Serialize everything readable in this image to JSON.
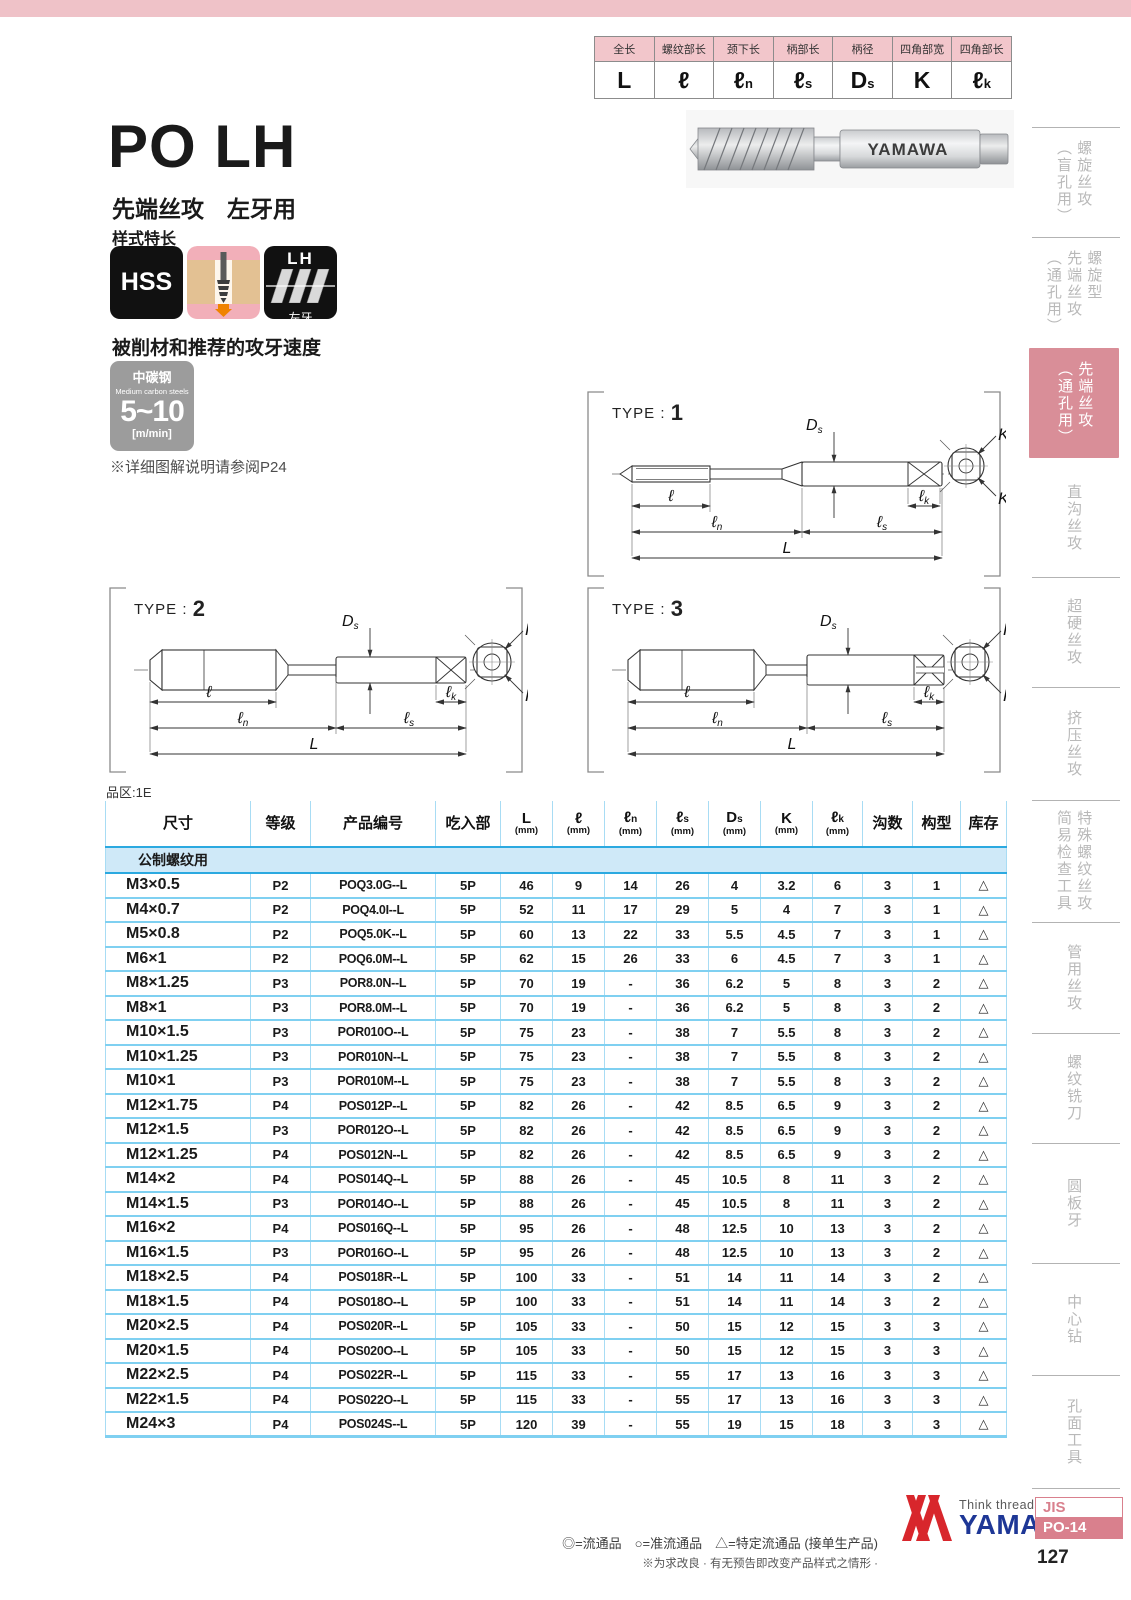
{
  "symbol_table": {
    "headers": [
      "全长",
      "螺纹部长",
      "颈下长",
      "柄部长",
      "柄径",
      "四角部宽",
      "四角部长"
    ],
    "symbols": [
      "L",
      "ℓ",
      "ℓn",
      "ℓs",
      "Ds",
      "K",
      "ℓk"
    ]
  },
  "header": {
    "title": "PO LH",
    "subtitle": "先端丝攻　左牙用",
    "features_label": "样式特长",
    "badge_hss": "HSS",
    "badge_lh_top": "LH",
    "badge_lh_bottom": "左牙",
    "photo_brand": "YAMAWA"
  },
  "speed": {
    "heading": "被削材和推荐的攻牙速度",
    "material_cn": "中碳钢",
    "material_en": "Medium carbon steels",
    "range": "5~10",
    "unit": "[m/min]",
    "note": "※详细图解说明请参阅P24"
  },
  "diagrams": {
    "label_prefix": "TYPE : ",
    "types": [
      "1",
      "2",
      "3"
    ],
    "dims": {
      "l": "ℓ",
      "ln": "ℓn",
      "ls": "ℓs",
      "L": "L",
      "Ds": "Ds",
      "lk": "ℓk",
      "K": "K"
    }
  },
  "table": {
    "zone_label": "品区:1E",
    "headers": [
      {
        "t": "尺寸"
      },
      {
        "t": "等级"
      },
      {
        "t": "产品编号"
      },
      {
        "t": "吃入部"
      },
      {
        "t": "L",
        "u": "(mm)"
      },
      {
        "t": "ℓ",
        "u": "(mm)"
      },
      {
        "t": "ℓn",
        "u": "(mm)"
      },
      {
        "t": "ℓs",
        "u": "(mm)"
      },
      {
        "t": "Ds",
        "u": "(mm)"
      },
      {
        "t": "K",
        "u": "(mm)"
      },
      {
        "t": "ℓk",
        "u": "(mm)"
      },
      {
        "t": "沟数"
      },
      {
        "t": "构型"
      },
      {
        "t": "库存"
      }
    ],
    "section_label": "公制螺纹用",
    "rows": [
      [
        "M3×0.5",
        "P2",
        "POQ3.0G--L",
        "5P",
        "46",
        "9",
        "14",
        "26",
        "4",
        "3.2",
        "6",
        "3",
        "1",
        "△"
      ],
      [
        "M4×0.7",
        "P2",
        "POQ4.0I--L",
        "5P",
        "52",
        "11",
        "17",
        "29",
        "5",
        "4",
        "7",
        "3",
        "1",
        "△"
      ],
      [
        "M5×0.8",
        "P2",
        "POQ5.0K--L",
        "5P",
        "60",
        "13",
        "22",
        "33",
        "5.5",
        "4.5",
        "7",
        "3",
        "1",
        "△"
      ],
      [
        "M6×1",
        "P2",
        "POQ6.0M--L",
        "5P",
        "62",
        "15",
        "26",
        "33",
        "6",
        "4.5",
        "7",
        "3",
        "1",
        "△"
      ],
      [
        "M8×1.25",
        "P3",
        "POR8.0N--L",
        "5P",
        "70",
        "19",
        "-",
        "36",
        "6.2",
        "5",
        "8",
        "3",
        "2",
        "△"
      ],
      [
        "M8×1",
        "P3",
        "POR8.0M--L",
        "5P",
        "70",
        "19",
        "-",
        "36",
        "6.2",
        "5",
        "8",
        "3",
        "2",
        "△"
      ],
      [
        "M10×1.5",
        "P3",
        "POR010O--L",
        "5P",
        "75",
        "23",
        "-",
        "38",
        "7",
        "5.5",
        "8",
        "3",
        "2",
        "△"
      ],
      [
        "M10×1.25",
        "P3",
        "POR010N--L",
        "5P",
        "75",
        "23",
        "-",
        "38",
        "7",
        "5.5",
        "8",
        "3",
        "2",
        "△"
      ],
      [
        "M10×1",
        "P3",
        "POR010M--L",
        "5P",
        "75",
        "23",
        "-",
        "38",
        "7",
        "5.5",
        "8",
        "3",
        "2",
        "△"
      ],
      [
        "M12×1.75",
        "P4",
        "POS012P--L",
        "5P",
        "82",
        "26",
        "-",
        "42",
        "8.5",
        "6.5",
        "9",
        "3",
        "2",
        "△"
      ],
      [
        "M12×1.5",
        "P3",
        "POR012O--L",
        "5P",
        "82",
        "26",
        "-",
        "42",
        "8.5",
        "6.5",
        "9",
        "3",
        "2",
        "△"
      ],
      [
        "M12×1.25",
        "P4",
        "POS012N--L",
        "5P",
        "82",
        "26",
        "-",
        "42",
        "8.5",
        "6.5",
        "9",
        "3",
        "2",
        "△"
      ],
      [
        "M14×2",
        "P4",
        "POS014Q--L",
        "5P",
        "88",
        "26",
        "-",
        "45",
        "10.5",
        "8",
        "11",
        "3",
        "2",
        "△"
      ],
      [
        "M14×1.5",
        "P3",
        "POR014O--L",
        "5P",
        "88",
        "26",
        "-",
        "45",
        "10.5",
        "8",
        "11",
        "3",
        "2",
        "△"
      ],
      [
        "M16×2",
        "P4",
        "POS016Q--L",
        "5P",
        "95",
        "26",
        "-",
        "48",
        "12.5",
        "10",
        "13",
        "3",
        "2",
        "△"
      ],
      [
        "M16×1.5",
        "P3",
        "POR016O--L",
        "5P",
        "95",
        "26",
        "-",
        "48",
        "12.5",
        "10",
        "13",
        "3",
        "2",
        "△"
      ],
      [
        "M18×2.5",
        "P4",
        "POS018R--L",
        "5P",
        "100",
        "33",
        "-",
        "51",
        "14",
        "11",
        "14",
        "3",
        "2",
        "△"
      ],
      [
        "M18×1.5",
        "P4",
        "POS018O--L",
        "5P",
        "100",
        "33",
        "-",
        "51",
        "14",
        "11",
        "14",
        "3",
        "2",
        "△"
      ],
      [
        "M20×2.5",
        "P4",
        "POS020R--L",
        "5P",
        "105",
        "33",
        "-",
        "50",
        "15",
        "12",
        "15",
        "3",
        "3",
        "△"
      ],
      [
        "M20×1.5",
        "P4",
        "POS020O--L",
        "5P",
        "105",
        "33",
        "-",
        "50",
        "15",
        "12",
        "15",
        "3",
        "3",
        "△"
      ],
      [
        "M22×2.5",
        "P4",
        "POS022R--L",
        "5P",
        "115",
        "33",
        "-",
        "55",
        "17",
        "13",
        "16",
        "3",
        "3",
        "△"
      ],
      [
        "M22×1.5",
        "P4",
        "POS022O--L",
        "5P",
        "115",
        "33",
        "-",
        "55",
        "17",
        "13",
        "16",
        "3",
        "3",
        "△"
      ],
      [
        "M24×3",
        "P4",
        "POS024S--L",
        "5P",
        "120",
        "39",
        "-",
        "55",
        "19",
        "15",
        "18",
        "3",
        "3",
        "△"
      ]
    ]
  },
  "footer": {
    "legend": "◎=流通品　○=准流通品　△=特定流通品 (接单生产品)",
    "note": "※为求改良 · 有无预告即改变产品样式之情形 ·",
    "tagline": "Think threads with",
    "brand": "YAMAWA"
  },
  "sidebar": {
    "tabs": [
      {
        "lines": [
          "螺旋丝攻",
          "（盲孔用）"
        ],
        "active": false
      },
      {
        "lines": [
          "螺旋型",
          "先端丝攻",
          "（通孔用）"
        ],
        "active": false
      },
      {
        "lines": [
          "先端丝攻",
          "（通孔用）"
        ],
        "active": true
      },
      {
        "lines": [
          "直沟丝攻"
        ],
        "active": false
      },
      {
        "lines": [
          "超硬丝攻"
        ],
        "active": false
      },
      {
        "lines": [
          "挤压丝攻"
        ],
        "active": false
      },
      {
        "lines": [
          "特殊螺纹丝攻",
          "简易检查工具"
        ],
        "active": false
      },
      {
        "lines": [
          "管用丝攻"
        ],
        "active": false
      },
      {
        "lines": [
          "螺纹铣刀"
        ],
        "active": false
      },
      {
        "lines": [
          "圆板牙"
        ],
        "active": false
      },
      {
        "lines": [
          "中心钻"
        ],
        "active": false
      },
      {
        "lines": [
          "孔面工具"
        ],
        "active": false
      }
    ],
    "jis_label": "JIS",
    "doc_code": "PO-14",
    "page_number": "127"
  },
  "colors": {
    "top_bar_pink": "#efc2c8",
    "table_header_pink": "#f2c6cb",
    "active_tab_pink": "#d98e98",
    "table_line_blue": "#7fd0f1",
    "strong_blue": "#2ba9e0",
    "brand_blue": "#1e3796",
    "brand_red": "#d8262c"
  }
}
